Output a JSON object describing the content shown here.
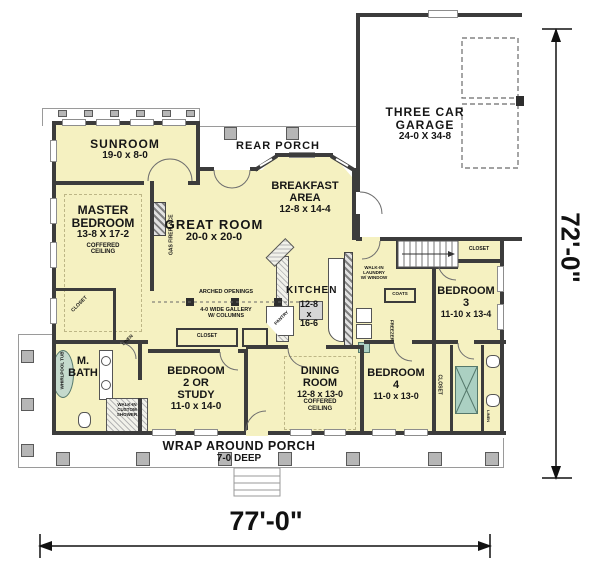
{
  "colors": {
    "room_fill": "#f5f1c1",
    "wall": "#3c3c3c",
    "porch_line": "#9a9a9a",
    "column_fill": "#b6b6b6",
    "fixture_teal": "#abd0c2"
  },
  "dims": {
    "bottom": "77'-0\"",
    "right": "72'-0\""
  },
  "rooms": {
    "sunroom": {
      "name": "SUNROOM",
      "size": "19-0 x 8-0"
    },
    "rear_porch": {
      "name": "REAR PORCH"
    },
    "garage": {
      "name_l1": "THREE CAR",
      "name_l2": "GARAGE",
      "size": "24-0 X 34-8"
    },
    "breakfast": {
      "name_l1": "BREAKFAST",
      "name_l2": "AREA",
      "size": "12-8 x 14-4"
    },
    "master": {
      "name_l1": "MASTER",
      "name_l2": "BEDROOM",
      "size": "13-8 X 17-2",
      "note_l1": "COFFERED",
      "note_l2": "CEILING"
    },
    "great": {
      "name": "GREAT ROOM",
      "size": "20-0 x 20-0"
    },
    "kitchen": {
      "name": "KITCHEN",
      "size_l1": "12-8",
      "size_l2": "x",
      "size_l3": "16-6"
    },
    "bed3": {
      "name_l1": "BEDROOM",
      "name_l2": "3",
      "size": "11-10 x 13-4"
    },
    "dining": {
      "name_l1": "DINING",
      "name_l2": "ROOM",
      "size": "12-8 x 13-0",
      "note_l1": "COFFERED",
      "note_l2": "CEILING"
    },
    "bed4": {
      "name_l1": "BEDROOM",
      "name_l2": "4",
      "size": "11-0 x 13-0"
    },
    "bed2": {
      "name_l1": "BEDROOM",
      "name_l2": "2 OR",
      "name_l3": "STUDY",
      "size": "11-0 x 14-0"
    },
    "mbath": {
      "name_l1": "M.",
      "name_l2": "BATH"
    },
    "porch": {
      "name": "WRAP AROUND PORCH",
      "size": "7-0 DEEP"
    }
  },
  "features": {
    "gallery_l1": "ARCHED OPENINGS",
    "gallery_l2": "4-0 WIDE GALLERY",
    "gallery_l3": "W/ COLUMNS",
    "fireplace": "GAS FIREPLACE",
    "tub": "WHIRLPOOL TUB",
    "shower_l1": "WALK-IN",
    "shower_l2": "CUSTOM",
    "shower_l3": "SHOWER",
    "laundry_l1": "WALK-IN",
    "laundry_l2": "LAUNDRY",
    "laundry_l3": "W/ WINDOW",
    "closet": "CLOSET",
    "linen": "LINEN",
    "coats": "COATS",
    "pantry": "PANTRY",
    "freezer": "FREEZER"
  }
}
